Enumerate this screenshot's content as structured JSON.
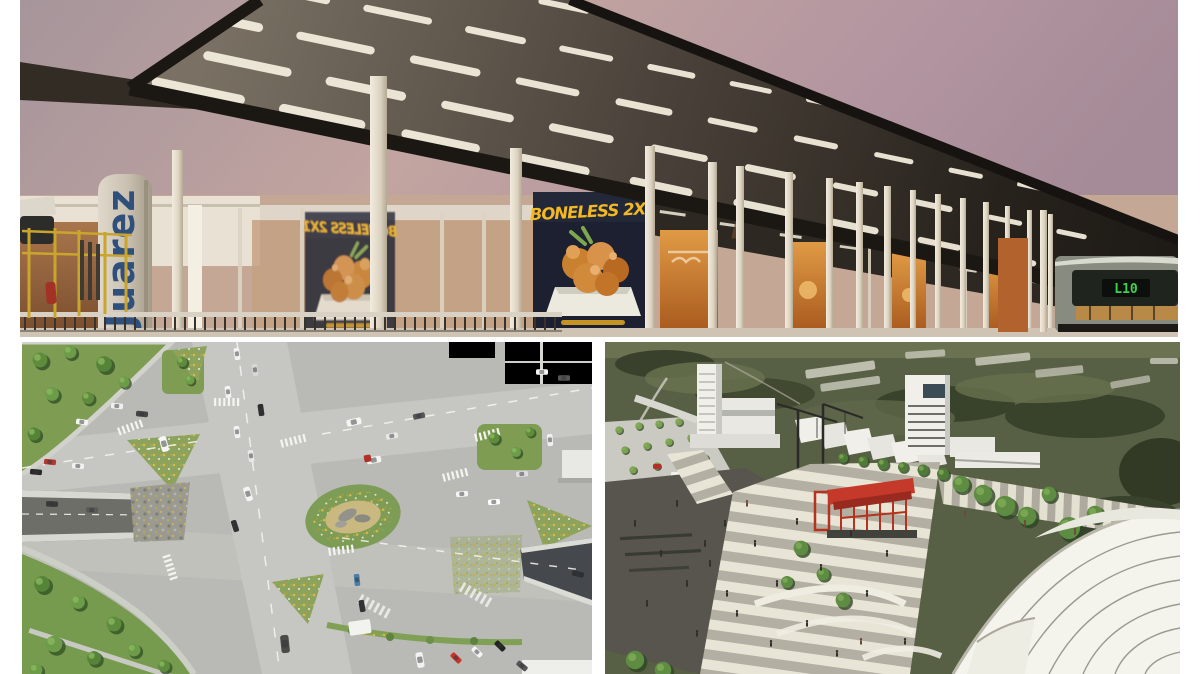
{
  "page": {
    "background": "#ffffff",
    "type": "photo-collage",
    "title": "Urban transit project renderings collage"
  },
  "station_panel": {
    "label": "BRT station rendering at dusk",
    "pylon_text": "Juarez",
    "poster_text": "BONELESS 2X1",
    "bus_route_display": "L10",
    "colors": {
      "sky_left": "#a6959b",
      "sky_mid": "#c2a4a0",
      "sky_right": "#a58b97",
      "canopy_dark": "#241f1a",
      "canopy_underside": "#6f6659",
      "light_strip": "#f6efdf",
      "column_light": "#efe8d9",
      "ad_orange": "#c97b2e",
      "poster_bg": "#1c2030",
      "poster_yellow": "#f3b822",
      "pylon_blue": "#2f4f7d",
      "led_green": "#3fd14f"
    }
  },
  "interchange_panel": {
    "label": "Aerial rendering of road interchange",
    "colors": {
      "asphalt": "#b9b9b5",
      "road_light": "#c6c6c2",
      "green": "#78994e",
      "tree_dark": "#3d5f2e",
      "flower_yellow": "#d8b84a",
      "underpass_dark": "#45484c",
      "marking_white": "#f4f4f0"
    }
  },
  "plaza_panel": {
    "label": "Aerial rendering of public plaza with tensile canopy",
    "colors": {
      "landscape": "#576044",
      "paving_light": "#e9e5d6",
      "paving_gray": "#b3afa2",
      "asphalt_dark": "#57554e",
      "building_white": "#f0efe9",
      "structure_red": "#c5392b",
      "canopy_white": "#f4f3ec"
    }
  }
}
